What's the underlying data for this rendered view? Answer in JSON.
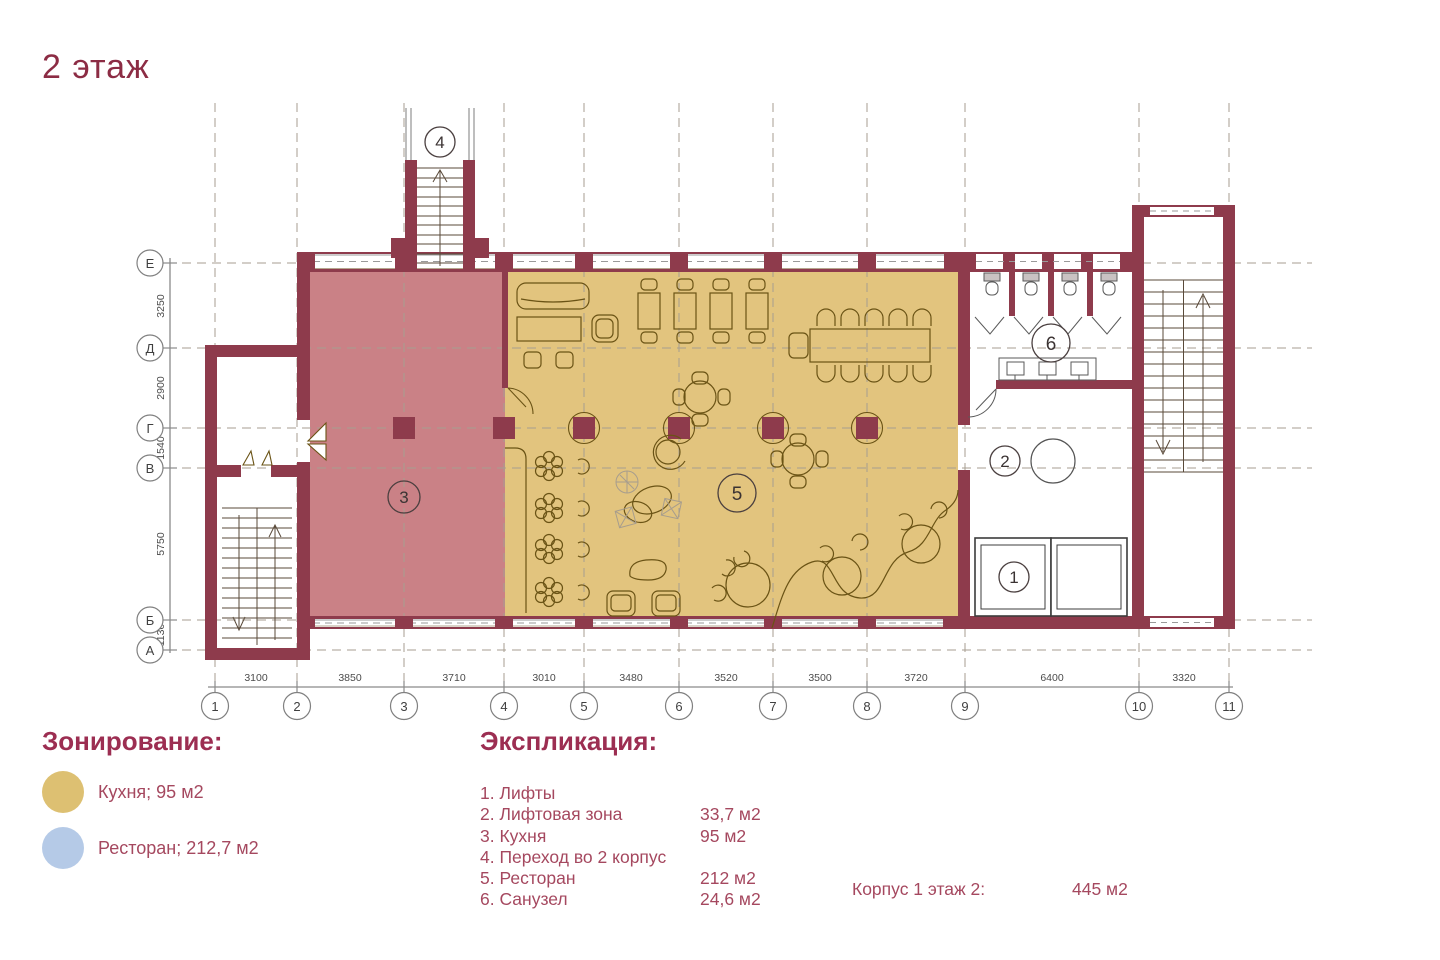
{
  "title": "2 этаж",
  "colors": {
    "wall": "#8e3b4c",
    "kitchen_zone": "#ca8186",
    "restaurant_zone": "#e2c47e",
    "legend_kitchen_swatch": "#ddc072",
    "legend_restaurant_swatch": "#b5cae7",
    "accent_text": "#9c2e52"
  },
  "legend": {
    "heading": "Зонирование:",
    "items": [
      {
        "name": "Кухня; 95 м2",
        "color": "#ddc072"
      },
      {
        "name": "Ресторан; 212,7 м2",
        "color": "#b5cae7"
      }
    ]
  },
  "explication": {
    "heading": "Экспликация:",
    "rows": [
      {
        "label": "1. Лифты",
        "value": ""
      },
      {
        "label": "2. Лифтовая зона",
        "value": "33,7 м2"
      },
      {
        "label": "3. Кухня",
        "value": "95 м2"
      },
      {
        "label": "4. Переход во 2 корпус",
        "value": ""
      },
      {
        "label": "5. Ресторан",
        "value": "212 м2"
      },
      {
        "label": "6. Санузел",
        "value": "24,6 м2"
      }
    ],
    "total_label": "Корпус 1 этаж 2:",
    "total_value": "445 м2"
  },
  "plan": {
    "axes_bottom": [
      "1",
      "2",
      "3",
      "4",
      "5",
      "6",
      "7",
      "8",
      "9",
      "10",
      "11"
    ],
    "dims_bottom": [
      "3100",
      "3850",
      "3710",
      "3010",
      "3480",
      "3520",
      "3500",
      "3720",
      "6400",
      "3320"
    ],
    "axes_left": [
      "Е",
      "Д",
      "Г",
      "В",
      "Б",
      "А"
    ],
    "dims_left": [
      "3250",
      "2900",
      "1540",
      "5750",
      "1130"
    ],
    "rooms": {
      "r1": "1",
      "r2": "2",
      "r3": "3",
      "r4": "4",
      "r5": "5",
      "r6": "6"
    }
  }
}
